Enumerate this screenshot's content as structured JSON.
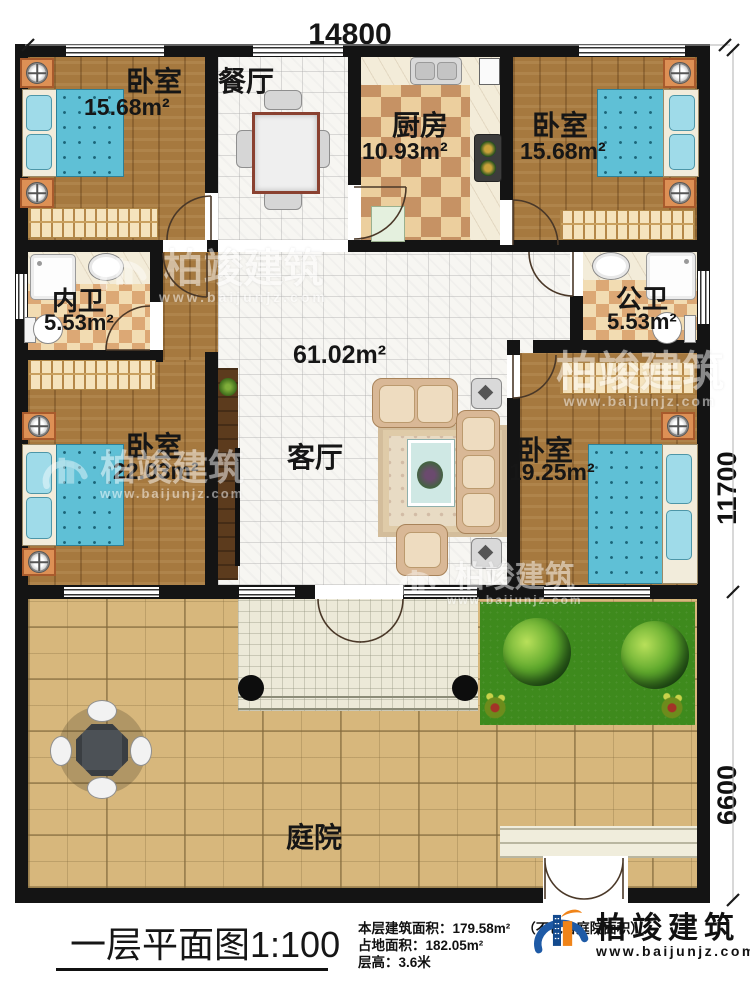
{
  "plan": {
    "title": "一层平面图1:100",
    "dimensions": {
      "width_top": "14800",
      "height_upper": "11700",
      "height_lower": "6600"
    },
    "rooms": {
      "bedroom_tl": {
        "name": "卧室",
        "area": "15.68m²"
      },
      "dining": {
        "name": "餐厅"
      },
      "kitchen": {
        "name": "厨房",
        "area": "10.93m²"
      },
      "bedroom_tr": {
        "name": "卧室",
        "area": "15.68m²"
      },
      "bath_inner": {
        "name": "内卫",
        "area": "5.53m²"
      },
      "bath_public": {
        "name": "公卫",
        "area": "5.53m²"
      },
      "bedroom_bl": {
        "name": "卧室",
        "area": "22.03m²"
      },
      "living": {
        "name": "客厅",
        "hall_area": "61.02m²"
      },
      "bedroom_br": {
        "name": "卧室",
        "area": "19.25m²"
      },
      "courtyard": {
        "name": "庭院"
      }
    }
  },
  "footer": {
    "stats": [
      {
        "label": "本层建筑面积：",
        "value": "179.58m²",
        "note": "（不包含庭院面积）"
      },
      {
        "label": "占地面积：",
        "value": "182.05m²",
        "note": ""
      },
      {
        "label": "层高：",
        "value": "3.6米",
        "note": ""
      }
    ],
    "brand": {
      "name": "柏竣建筑",
      "url": "www.baijunjz.com"
    }
  },
  "watermark": {
    "name": "柏竣建筑",
    "url": "www.baijunjz.com"
  },
  "colors": {
    "accent_blue": "#1e5aa6",
    "accent_orange": "#f08419",
    "wall": "#141414"
  }
}
